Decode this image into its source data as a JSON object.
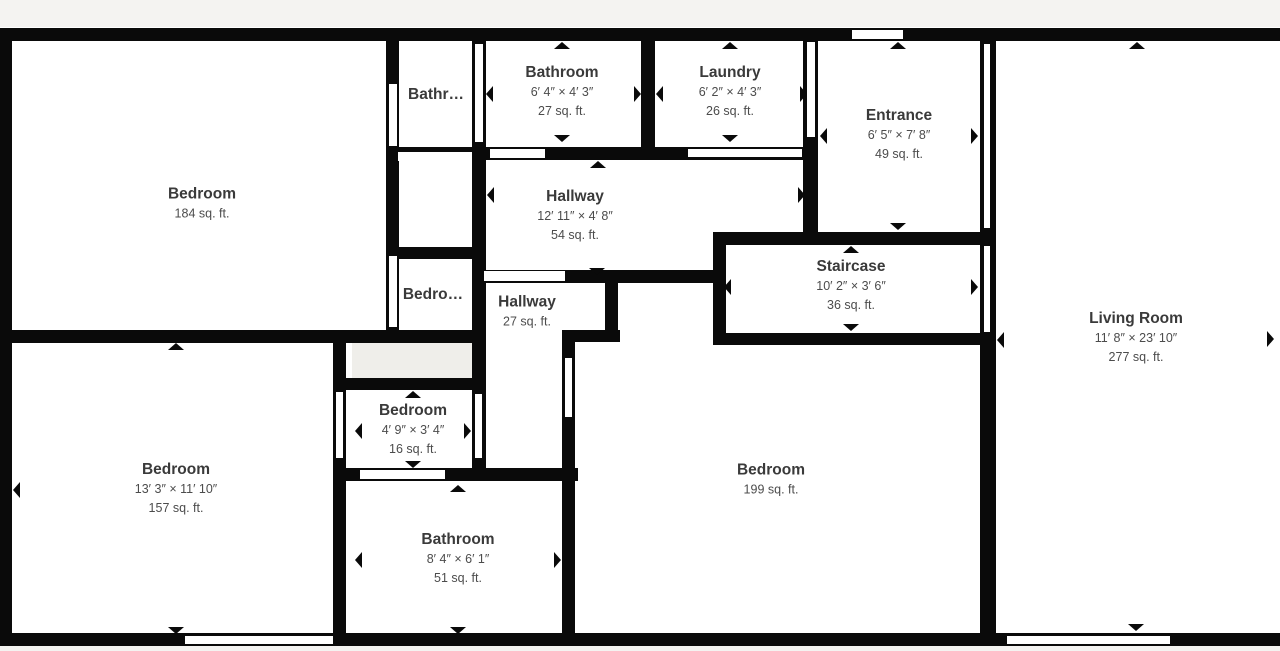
{
  "colors": {
    "wall": "#0a0a0a",
    "floor_background": "#ffffff",
    "margin_background": "#f4f3f1",
    "closet_fill": "#efeeea",
    "room_title_text": "#3a3a3a",
    "room_subtitle_text": "#4c4c4c"
  },
  "rooms": [
    {
      "id": "bedroom-184",
      "name": "Bedroom",
      "area": "184 sq. ft."
    },
    {
      "id": "bathroom-small",
      "name": "Bathr…"
    },
    {
      "id": "bathroom-27",
      "name": "Bathroom",
      "dims": "6′ 4″ × 4′ 3″",
      "area": "27 sq. ft."
    },
    {
      "id": "laundry",
      "name": "Laundry",
      "dims": "6′ 2″ × 4′ 3″",
      "area": "26 sq. ft."
    },
    {
      "id": "entrance",
      "name": "Entrance",
      "dims": "6′ 5″ × 7′ 8″",
      "area": "49 sq. ft."
    },
    {
      "id": "hallway-54",
      "name": "Hallway",
      "dims": "12′ 11″ × 4′ 8″",
      "area": "54 sq. ft."
    },
    {
      "id": "bedroom-small",
      "name": "Bedro…"
    },
    {
      "id": "hallway-27",
      "name": "Hallway",
      "area": "27 sq. ft."
    },
    {
      "id": "staircase",
      "name": "Staircase",
      "dims": "10′ 2″ × 3′ 6″",
      "area": "36 sq. ft."
    },
    {
      "id": "living-room",
      "name": "Living Room",
      "dims": "11′ 8″ × 23′ 10″",
      "area": "277 sq. ft."
    },
    {
      "id": "bedroom-16",
      "name": "Bedroom",
      "dims": "4′ 9″ × 3′ 4″",
      "area": "16 sq. ft."
    },
    {
      "id": "bedroom-157",
      "name": "Bedroom",
      "dims": "13′ 3″ × 11′ 10″",
      "area": "157 sq. ft."
    },
    {
      "id": "bathroom-51",
      "name": "Bathroom",
      "dims": "8′ 4″ × 6′ 1″",
      "area": "51 sq. ft."
    },
    {
      "id": "bedroom-199",
      "name": "Bedroom",
      "area": "199 sq. ft."
    }
  ]
}
